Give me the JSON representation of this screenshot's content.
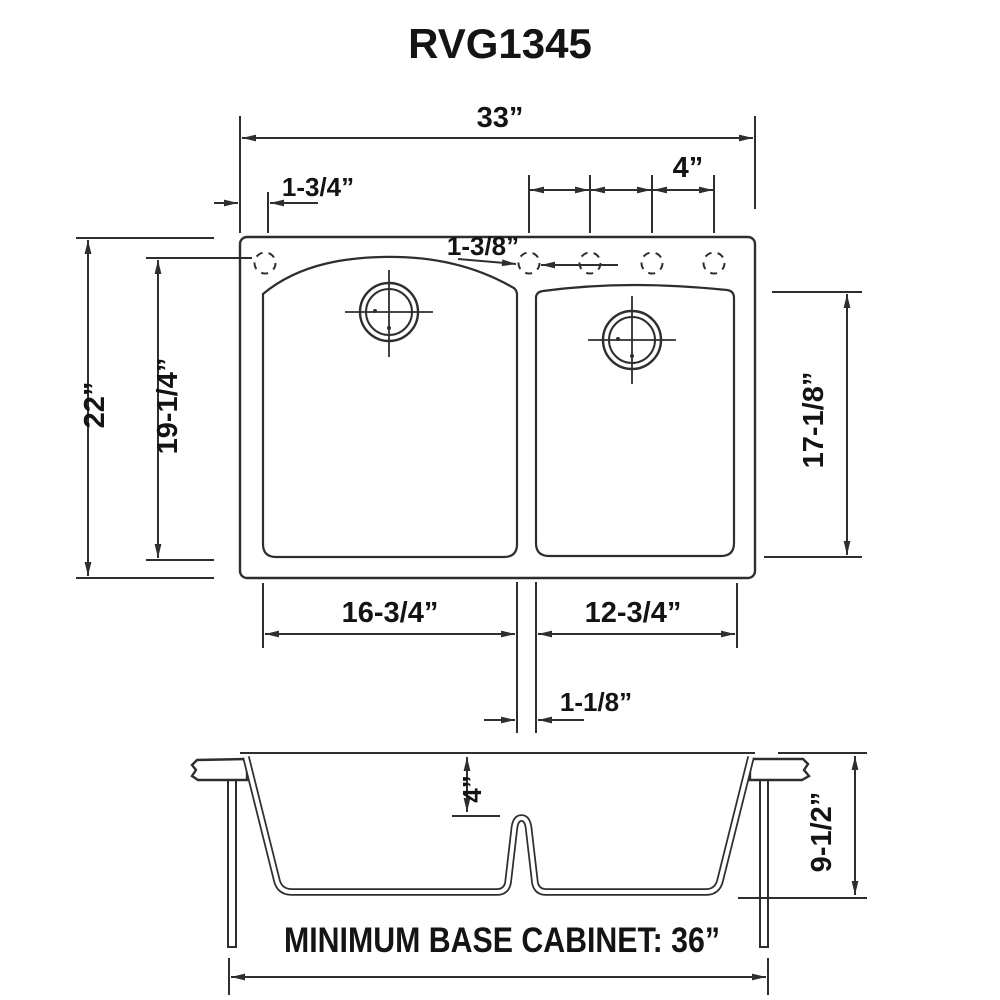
{
  "title": "RVG1345",
  "top_view": {
    "overall_width": "33”",
    "overall_front_to_back": "22”",
    "faucet_hole_offset": "1-3/4”",
    "faucet_hole_spacing": "4”",
    "faucet_hole_diameter": "1-3/8”",
    "left_bowl_front_to_back": "19-1/4”",
    "right_bowl_front_to_back": "17-1/8”",
    "left_bowl_width": "16-3/4”",
    "right_bowl_width": "12-3/4”",
    "divider_width": "1-1/8”"
  },
  "front_view": {
    "divider_depth_from_top": "4”",
    "bowl_depth": "9-1/2”",
    "base_cabinet_note": "MINIMUM BASE CABINET: 36”"
  },
  "colors": {
    "line": "#2e2e2e",
    "text": "#141414",
    "background": "#ffffff"
  }
}
